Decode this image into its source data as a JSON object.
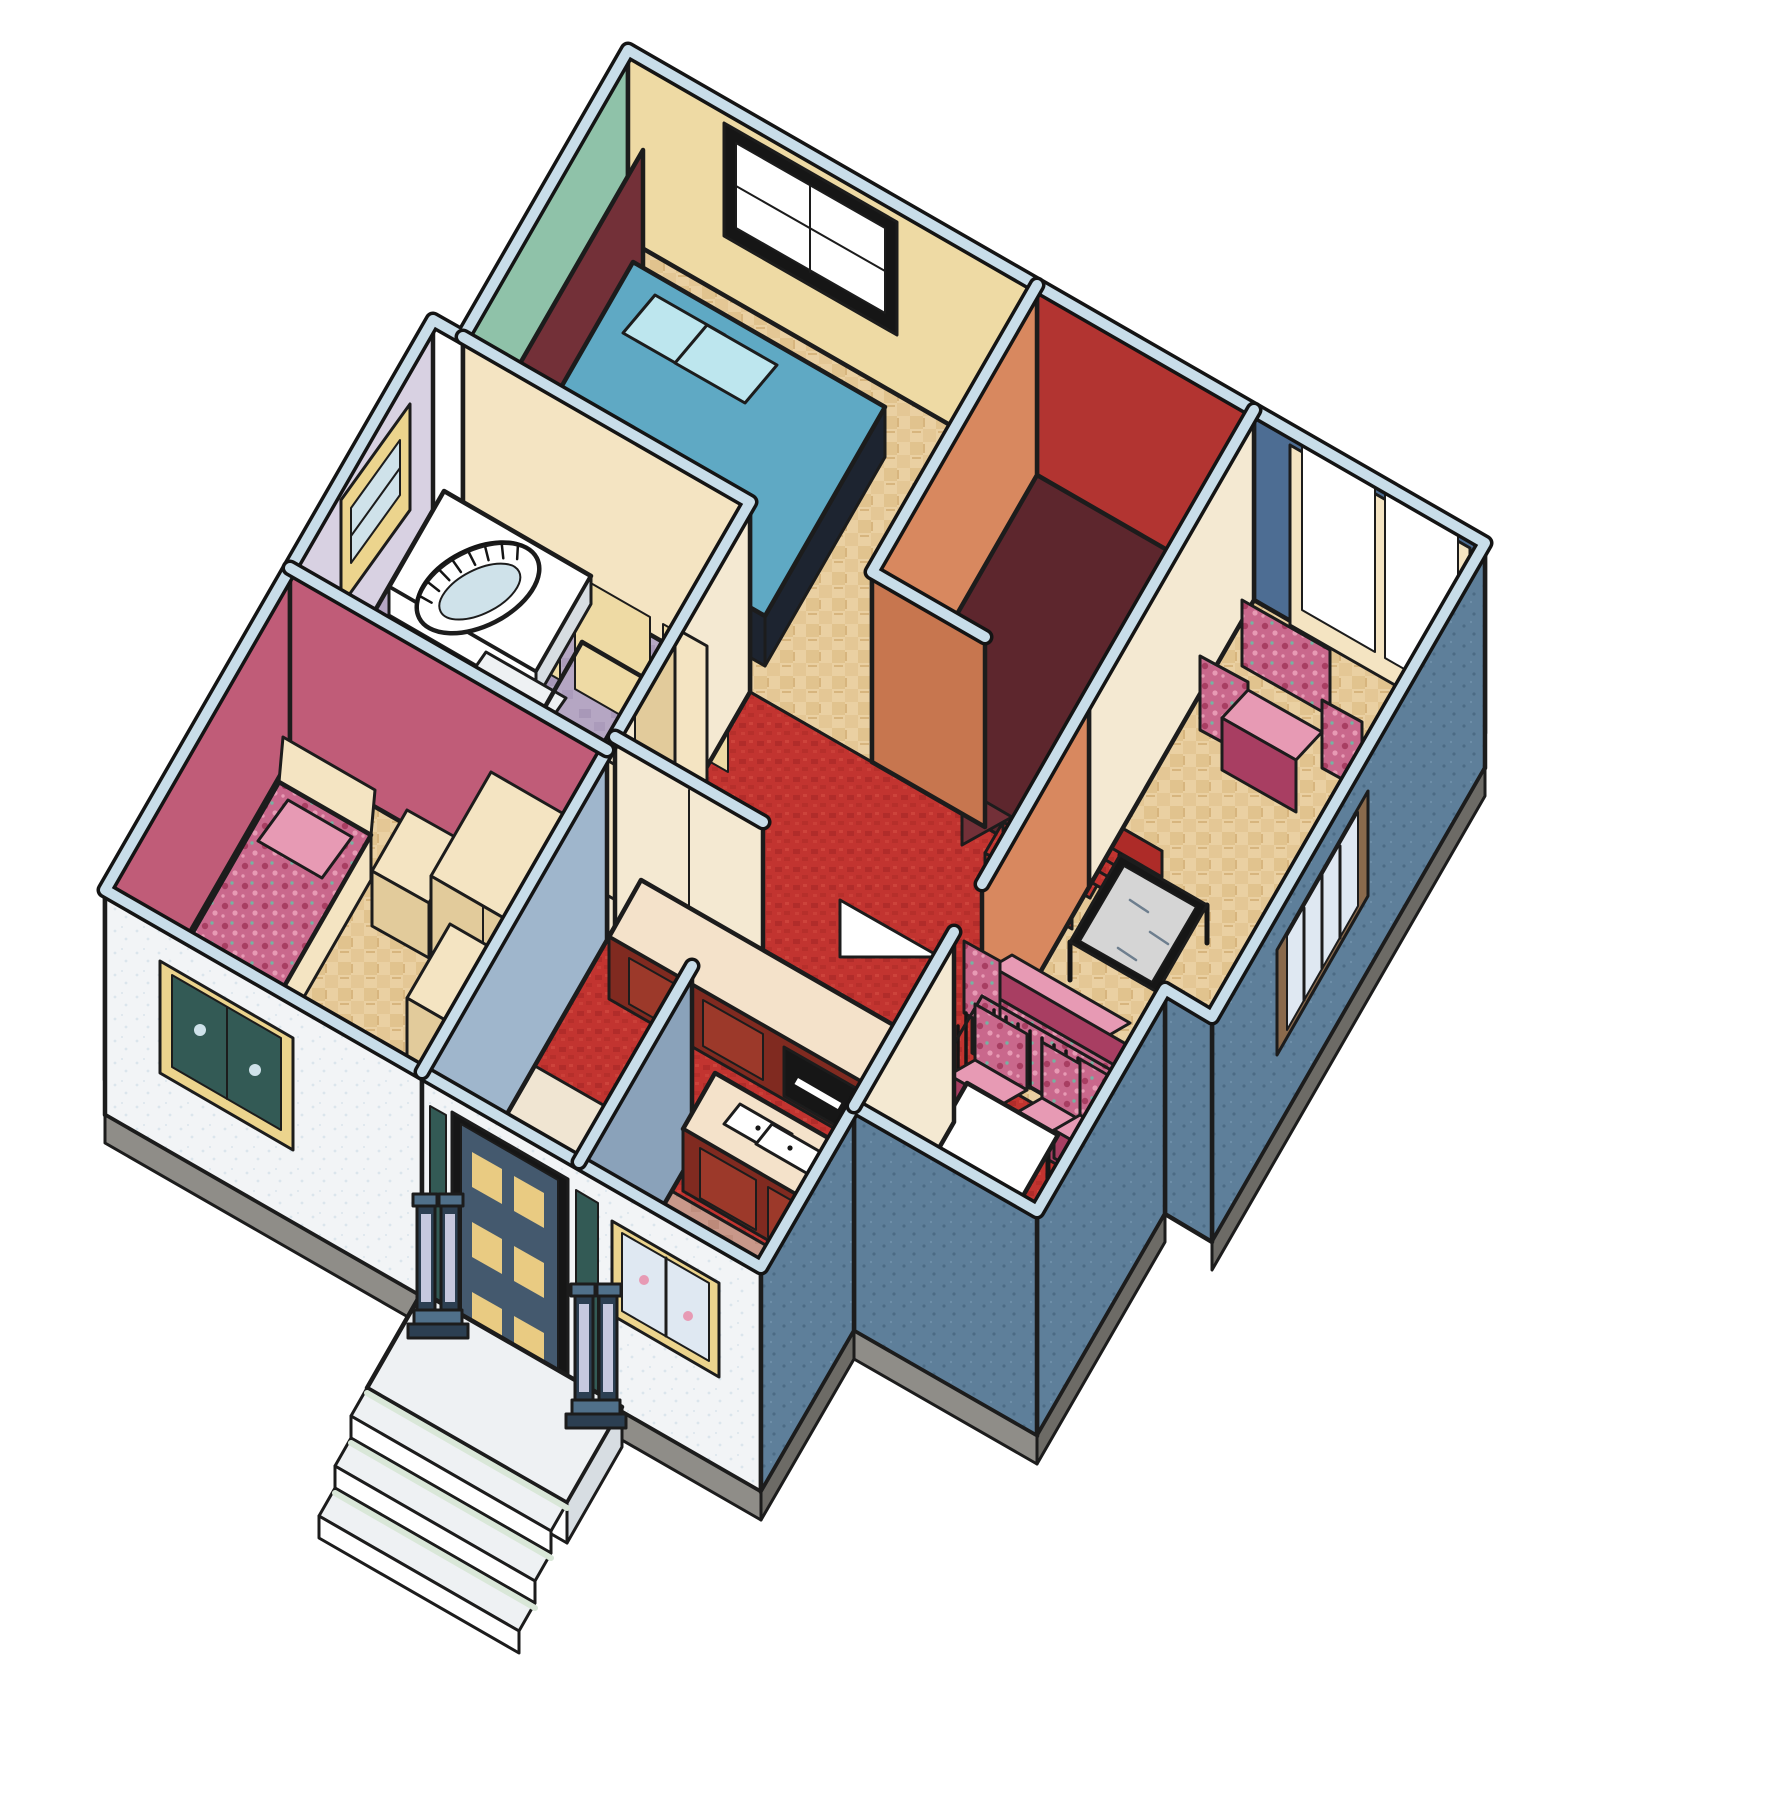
{
  "scene": {
    "type": "isometric-house-cutaway",
    "description": "3D cutaway floor-plan illustration of a single-family house interior, no visible text",
    "view": "isometric bird's-eye cutaway",
    "rooms": [
      {
        "name": "master-bedroom",
        "wall_colors": [
          "teal",
          "cream-yellow"
        ],
        "floor": "parquet",
        "furniture": [
          "double-bed-swirl-spread",
          "maroon-headboard",
          "pillows",
          "closet-sliding-doors",
          "four-pane-window"
        ]
      },
      {
        "name": "bathroom",
        "wall_colors": [
          "lavender"
        ],
        "floor": "mauve-tile",
        "furniture": [
          "arched-bathtub",
          "tub-steps",
          "toilet",
          "frosted-shower-stall",
          "yellow-trim-window"
        ]
      },
      {
        "name": "second-bedroom",
        "wall_colors": [
          "rose-pink"
        ],
        "floor": "parquet",
        "furniture": [
          "single-bed-floral-spread",
          "cream-headboard",
          "nightstand",
          "wardrobes",
          "open-door",
          "front-window"
        ]
      },
      {
        "name": "living-room",
        "wall_colors": [
          "slate-blue"
        ],
        "floor": "parquet",
        "furniture": [
          "floral-armchair",
          "floral-sofa",
          "glass-coffee-table",
          "sliding-window",
          "curtained-window"
        ]
      },
      {
        "name": "dining-area",
        "wall_colors": [
          "cream"
        ],
        "floor": "red-carpet",
        "furniture": [
          "white-dining-table",
          "floral-dining-chairs",
          "railing-with-balusters"
        ]
      },
      {
        "name": "kitchen",
        "wall_colors": [
          "cream",
          "blue-gray"
        ],
        "floor": "red-carpet-and-rose-tile",
        "furniture": [
          "back-counter",
          "island-with-double-sink",
          "oven",
          "curtained-front-window"
        ]
      },
      {
        "name": "hallway-stairs",
        "wall_colors": [
          "terracotta",
          "red"
        ],
        "floor": "red-carpet",
        "furniture": [
          "winder-staircase",
          "open-doors",
          "triangle-cutout"
        ]
      },
      {
        "name": "entry",
        "wall_colors": [
          "white-exterior",
          "blue-gray-interior"
        ],
        "floor": "cream-tile",
        "furniture": [
          "front-door-with-gold-lites",
          "sidelights",
          "porch-steps",
          "pillar-lamp-posts"
        ]
      }
    ]
  },
  "colors": {
    "outline": "#1c1c1c",
    "cap": "#c8dde9",
    "extWhite": "#f2f4f6",
    "extSpeck": "#dbe5ec",
    "extBlue": "#5e7f9a",
    "extBlueDk": "#4c6b85",
    "foundation": "#8f8d88",
    "foundationDk": "#6d6b66",
    "teal": "#8fc2a9",
    "cream": "#eedaa4",
    "hallCream": "#f4e9d2",
    "terracotta": "#d8885f",
    "terracottaDk": "#c7764f",
    "slate": "#4d6d93",
    "lavender": "#d8d1e2",
    "lavenderDk": "#b7abc8",
    "pink": "#c05c78",
    "pinkDk": "#a84a64",
    "foyerBlue": "#9fb6cc",
    "foyerBlueDk": "#8aa2ba",
    "redWall": "#b23431",
    "carpetA": "#c23430",
    "carpetB": "#ad2b28",
    "carpetC": "#d24a40",
    "parquetA": "#ead0a2",
    "parquetB": "#d9b87e",
    "parquetC": "#c9a465",
    "tileMA": "#b5a6c3",
    "tileMB": "#a595b5",
    "tileMline": "#e9e4f0",
    "tileRA": "#c9988a",
    "tileRB": "#ba8776",
    "tileRline": "#f2e3d8",
    "tileCA": "#f0e5d2",
    "tileCline": "#ddcba9",
    "maroon": "#733038",
    "maroonDk": "#5d262d",
    "navy": "#1d2430",
    "swirlA": "#5fa9c4",
    "swirlB": "#8fd2e2",
    "swirlC": "#3c7ca8",
    "swirlD": "#bde6ee",
    "floralA": "#c9688c",
    "floralB": "#a83e62",
    "floralC": "#e79ab4",
    "floralD": "#76b2a2",
    "furnCream": "#f4e4c2",
    "furnCreamDk": "#e2cb9b",
    "counter": "#f4e2ca",
    "cabinet": "#802a20",
    "cabinetDk": "#67211a",
    "cabinetPanel": "#9c392a",
    "white": "#ffffff",
    "gold": "#e9cb82",
    "glass": "#ffffff",
    "glassBlue": "#cfe2ea",
    "frost": "#e9eef5",
    "frostLn": "#c3cfdf",
    "chrome": "#9aa7b4",
    "mint": "#d9e7d8",
    "stone": "#eef1f3",
    "stoneShade": "#d7dde2",
    "lampBody": "#50708a",
    "lampDk": "#2c3f52",
    "lampPanel": "#c6c8de",
    "trimYellow": "#ecd48d",
    "frameBrown": "#8a6a4c",
    "curtain": "#dfe8f2",
    "curtainLn": "#aebfd4",
    "doorSlate": "#44596e",
    "plantGlass": "#335a55"
  }
}
